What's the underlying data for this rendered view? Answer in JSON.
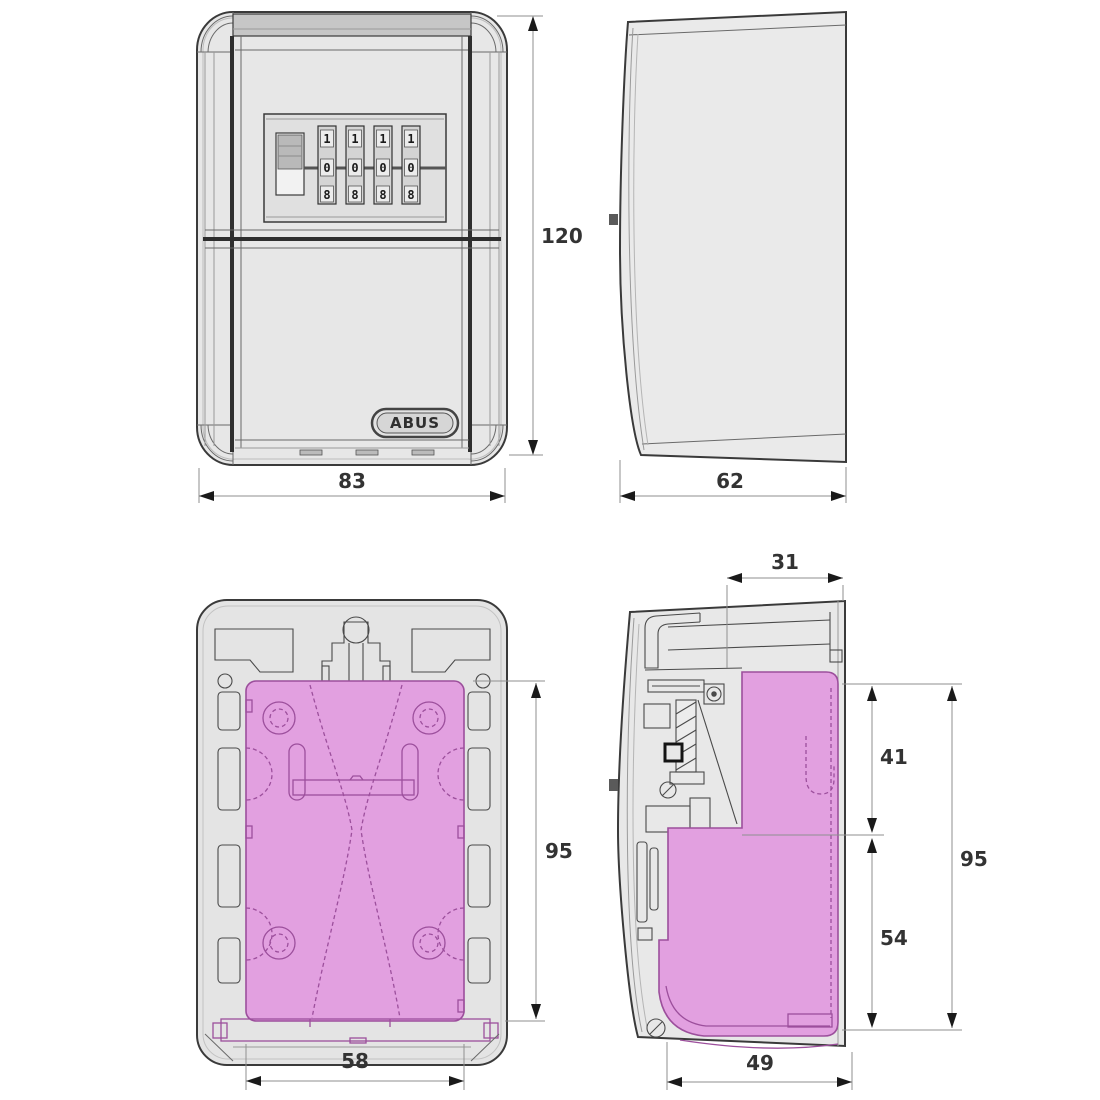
{
  "drawing": {
    "type": "technical-drawing",
    "subject": "wall mounted key safe with four combination dials"
  },
  "colors": {
    "background": "#ffffff",
    "body_grey": "#e7e7e7",
    "band_grey": "#c6c6c6",
    "outline": "#3a3a3a",
    "highlight_pink": "#e2a0e0",
    "highlight_line": "#9c4f9c",
    "dimension_text": "#333333"
  },
  "logo": {
    "text": "ABUS"
  },
  "lock": {
    "dial_count": 4,
    "dial_digits": [
      "1",
      "0",
      "8"
    ]
  },
  "dimensions": {
    "front_height": "120",
    "front_width": "83",
    "side_depth": "62",
    "back_plate_height": "95",
    "back_plate_width": "58",
    "section_top_depth": "31",
    "section_upper_height": "41",
    "section_total_height": "95",
    "section_lower_height": "54",
    "section_bottom_depth": "49"
  }
}
